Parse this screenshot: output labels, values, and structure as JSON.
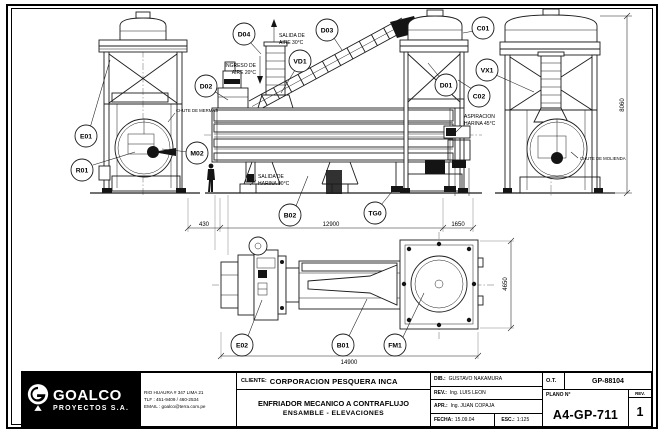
{
  "drawing": {
    "balloons": {
      "e01": "E01",
      "r01": "R01",
      "m02": "M02",
      "d02": "D02",
      "d04": "D04",
      "vd1": "VD1",
      "d03": "D03",
      "d01": "D01",
      "c01": "C01",
      "vx1": "VX1",
      "c02": "C02",
      "b02": "B02",
      "tg0": "TG0",
      "e02": "E02",
      "b01": "B01",
      "fm1": "FM1"
    },
    "annotations": {
      "air_out_l1": "SALIDA DE",
      "air_out_l2": "AIRE 30°C",
      "air_in_l1": "INGRESO DE",
      "air_in_l2": "AIRE 20°C",
      "meal_out_l1": "SALIDA DE",
      "meal_out_l2": "HARINA 90°C",
      "suction_l1": "ASPIRACION",
      "suction_l2": "HARINA 45°C",
      "chute_mermas": "CHUTE DE MERMAS",
      "chute_molienda": "CHUTE DE MOLIENDA"
    },
    "dimensions": {
      "front_left": "430",
      "front_middle": "12900",
      "front_right": "1650",
      "side_height": "8060",
      "plan_length": "14900",
      "plan_width": "4650"
    }
  },
  "title_block": {
    "company": {
      "name": "GOALCO",
      "subtitle": "PROYECTOS S.A.",
      "address": "RIO HUAURA # 347 LIMA 21",
      "phone": "TLF : 451-9409 / 460-2534",
      "email": "EMAIL : goalco@terra.com.pe"
    },
    "client_label": "CLIENTE:",
    "client": "CORPORACION PESQUERA INCA",
    "title_line1": "ENFRIADOR MECANICO A CONTRAFLUJO",
    "title_line2": "ENSAMBLE - ELEVACIONES",
    "drawn_label": "DIB.:",
    "drawn": "GUSTAVO NAKAMURA",
    "rev_label": "REV.:",
    "reviewed": "Ing. LUIS LEON",
    "apr_label": "APR.:",
    "approved": "Ing. JUAN COPAJA",
    "date_label": "FECHA:",
    "date": "15.09.04",
    "scale_label": "ESC.:",
    "scale": "1:125",
    "ot_label": "O.T.",
    "ot": "GP-88104",
    "plano_label": "PLANO N°",
    "plano": "A4-GP-711",
    "rev_col_label": "REV.",
    "rev_number": "1"
  }
}
